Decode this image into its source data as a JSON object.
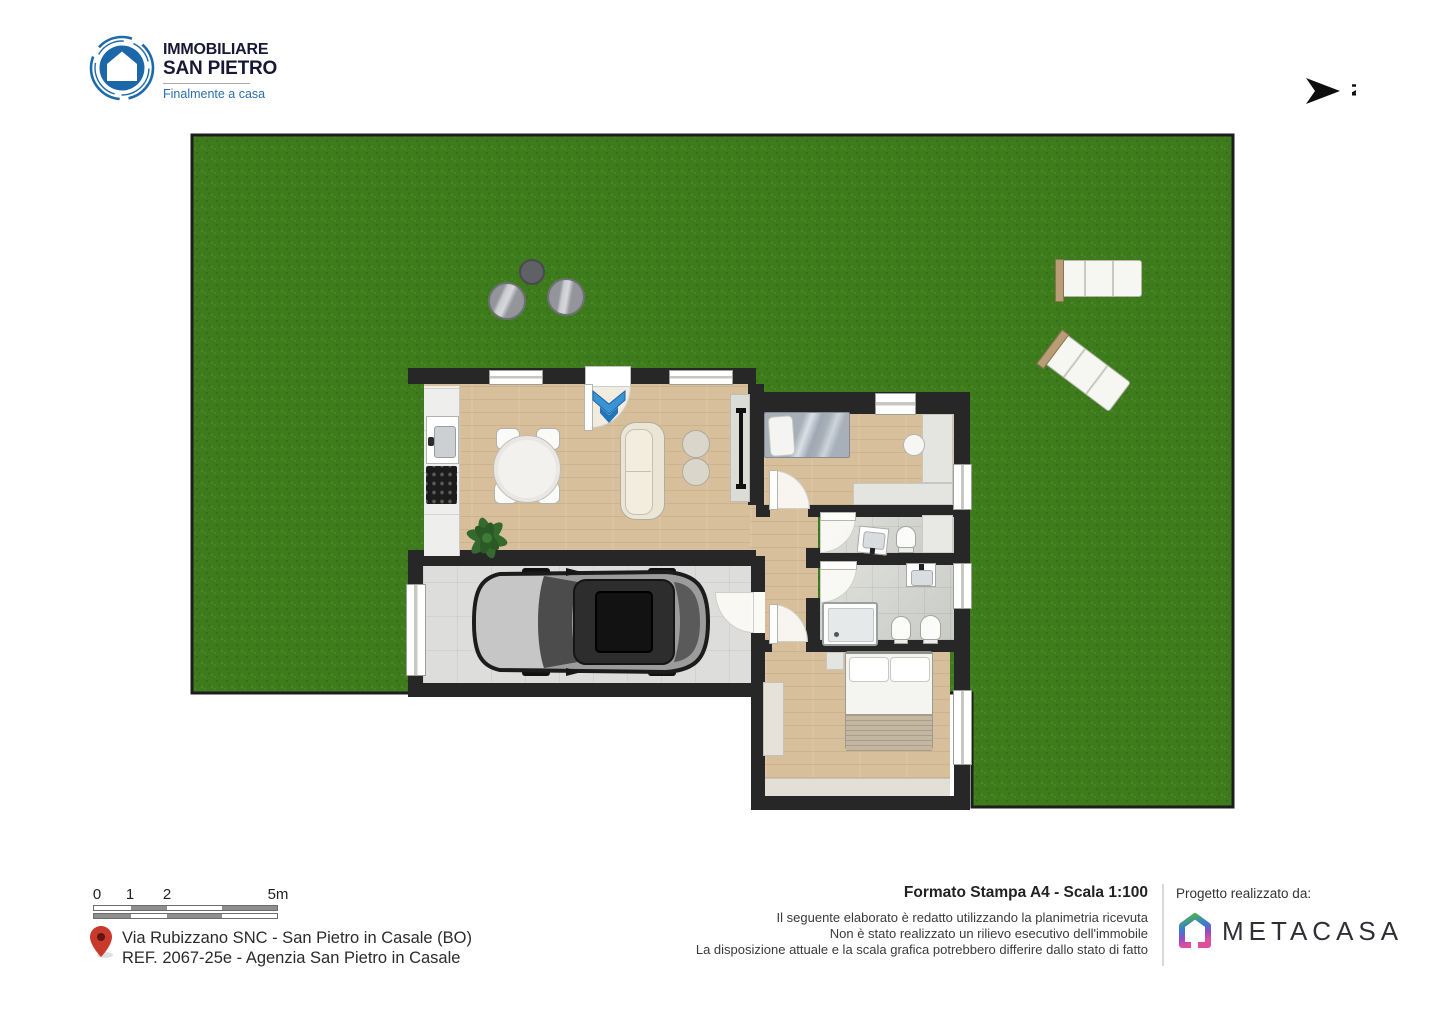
{
  "brand": {
    "name_line1": "IMMOBILIARE",
    "name_line2": "SAN PIETRO",
    "tagline": "Finalmente a casa",
    "logo_blue": "#1d6aab",
    "text_navy": "#181836"
  },
  "compass": {
    "label": "N"
  },
  "plan": {
    "colors": {
      "grass": "#3e7b1d",
      "wall": "#272727",
      "wood_floor": "#d8bf9b",
      "tile_floor": "#d3d5d0",
      "garage_floor": "#dddddb",
      "entrance_arrow_blue": "#2e8cce"
    }
  },
  "scale_bar": {
    "labels": [
      "0",
      "1",
      "2",
      "5m"
    ]
  },
  "location": {
    "pin_color": "#c9392c",
    "address_line1": "Via Rubizzano SNC - San Pietro in Casale (BO)",
    "address_line2": "REF. 2067-25e - Agenzia San Pietro in Casale"
  },
  "print_info": {
    "title": "Formato Stampa A4 - Scala 1:100",
    "disclaimer": [
      "Il seguente elaborato è redatto utilizzando la planimetria ricevuta",
      "Non è stato realizzato un rilievo esecutivo dell'immobile",
      "La disposizione attuale e la scala grafica potrebbero differire dallo stato di fatto"
    ]
  },
  "credits": {
    "label": "Progetto realizzato da:",
    "brand": "METACASA"
  }
}
